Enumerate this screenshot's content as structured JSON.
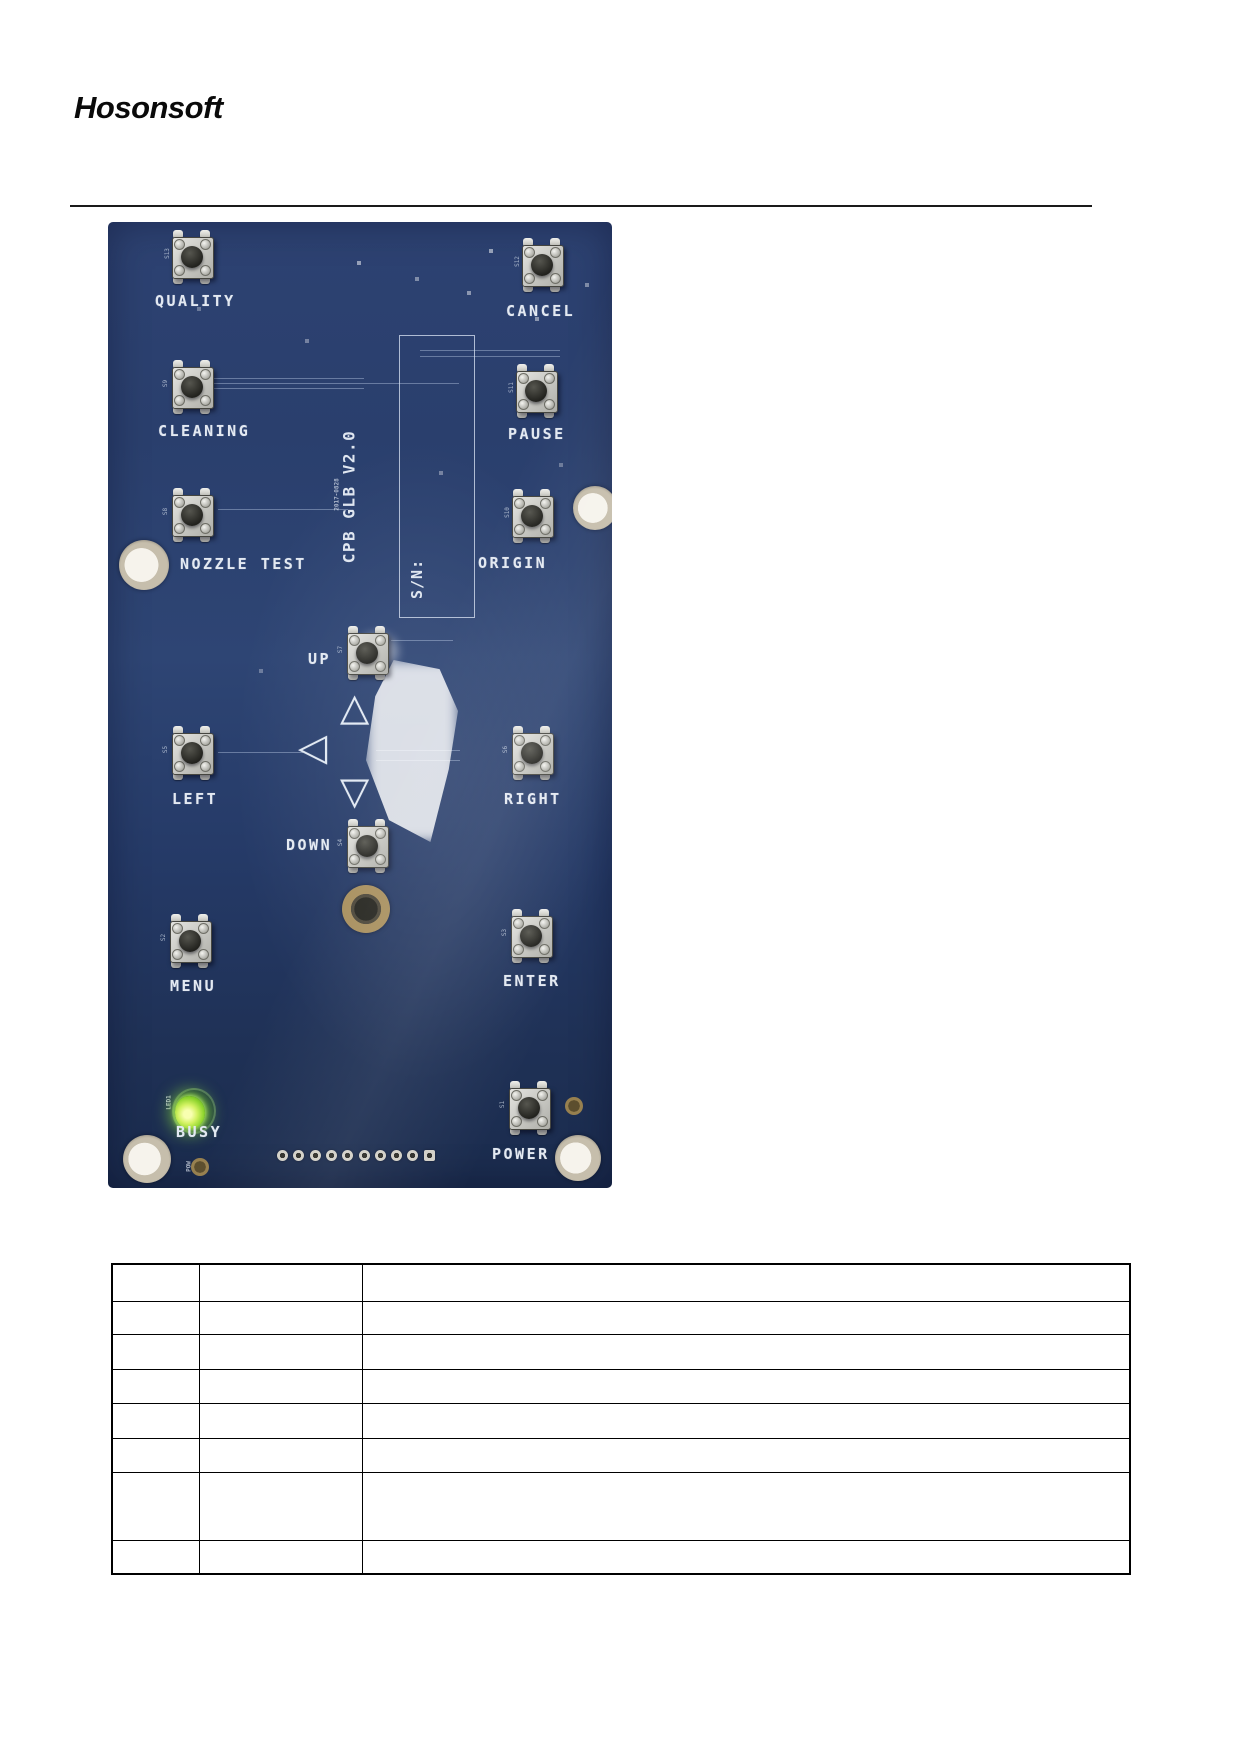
{
  "header": {
    "logo": "Hosonsoft"
  },
  "board": {
    "silkscreen": {
      "version": "CPB GLB V2.0",
      "serial_label": "S/N:",
      "date_code": "2017-0828",
      "led_label": "LED1",
      "busy_label": "BUSY",
      "pow_label": "POW"
    },
    "colors": {
      "board_blue": "#273c6a",
      "led_green": "#8ee32f",
      "silkscreen_white": "#e3e9f2"
    },
    "buttons": [
      {
        "id": "quality",
        "label": "QUALITY",
        "designator": "S13"
      },
      {
        "id": "cancel",
        "label": "CANCEL",
        "designator": "S12"
      },
      {
        "id": "cleaning",
        "label": "CLEANING",
        "designator": "S9"
      },
      {
        "id": "pause",
        "label": "PAUSE",
        "designator": "S11"
      },
      {
        "id": "nozzle-test",
        "label": "NOZZLE TEST",
        "designator": "S8"
      },
      {
        "id": "origin",
        "label": "ORIGIN",
        "designator": "S10"
      },
      {
        "id": "up",
        "label": "UP",
        "designator": "S7"
      },
      {
        "id": "left",
        "label": "LEFT",
        "designator": "S5"
      },
      {
        "id": "right",
        "label": "RIGHT",
        "designator": "S6"
      },
      {
        "id": "down",
        "label": "DOWN",
        "designator": "S4"
      },
      {
        "id": "menu",
        "label": "MENU",
        "designator": "S2"
      },
      {
        "id": "enter",
        "label": "ENTER",
        "designator": "S3"
      },
      {
        "id": "power",
        "label": "POWER",
        "designator": "S1"
      }
    ],
    "status_led": {
      "label": "BUSY",
      "state": "on",
      "color": "#8ee32f"
    },
    "arrows": [
      {
        "id": "arrow-up",
        "glyph": "△"
      },
      {
        "id": "arrow-left",
        "glyph": "◁"
      },
      {
        "id": "arrow-down",
        "glyph": "▽"
      }
    ],
    "pin_header_pads": 10
  },
  "table": {
    "columns": [
      "",
      "",
      ""
    ],
    "rows": [
      [
        "",
        "",
        ""
      ],
      [
        "",
        "",
        ""
      ],
      [
        "",
        "",
        ""
      ],
      [
        "",
        "",
        ""
      ],
      [
        "",
        "",
        ""
      ],
      [
        "",
        "",
        ""
      ],
      [
        "",
        "",
        ""
      ],
      [
        "",
        "",
        ""
      ]
    ]
  }
}
